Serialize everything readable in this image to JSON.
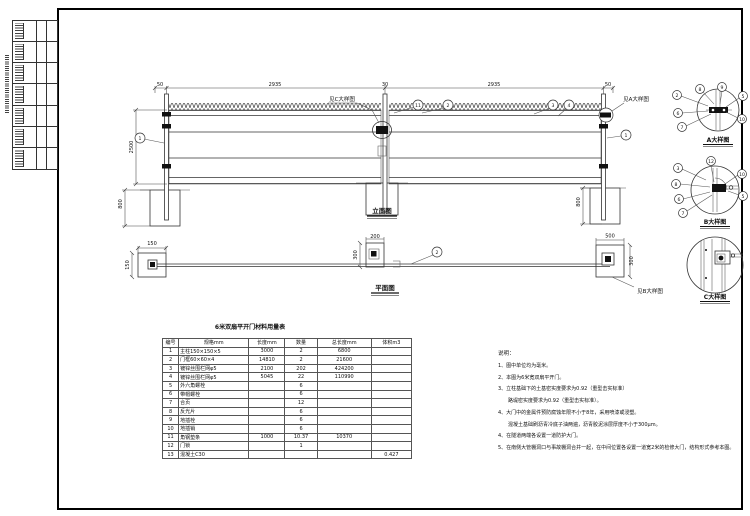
{
  "frame": {
    "margin_text": ""
  },
  "elevation": {
    "label": "立面图",
    "dims": {
      "top_left_offset": "50",
      "leaf1": "2935",
      "center_gap": "30",
      "leaf2": "2935",
      "top_right_offset": "50",
      "gate_height": "2500",
      "footing_left": "800",
      "footing_right": "800"
    },
    "refs": {
      "detail_a": "见A大样图",
      "detail_c": "见C大样图"
    },
    "callouts": {
      "left_post": "1",
      "center_left": "11",
      "center_right": "2",
      "right_a": "3",
      "right_b": "4",
      "right_post": "1"
    }
  },
  "plan": {
    "label": "平面图",
    "dims": {
      "left_block_w": "150",
      "left_block_h": "150",
      "center_block_w": "200",
      "center_block_h": "300",
      "right_block_w": "500",
      "right_block_h": "300"
    },
    "ref_detail_b": "见B大样图",
    "callout_rail": "2"
  },
  "details": {
    "a": {
      "label": "A大样图",
      "callouts": [
        "2",
        "8",
        "9",
        "5",
        "6",
        "7",
        "10"
      ]
    },
    "b": {
      "label": "B大样图",
      "callouts": [
        "3",
        "12",
        "8",
        "6",
        "7",
        "10",
        "5"
      ]
    },
    "c": {
      "label": "C大样图"
    }
  },
  "table": {
    "title": "6米双扇平开门材料用量表",
    "headers": [
      "编号",
      "规格mm",
      "长度mm",
      "数量",
      "总长度mm",
      "体积m3"
    ],
    "rows": [
      [
        "1",
        "主柱150×150×5",
        "3000",
        "2",
        "6800",
        ""
      ],
      [
        "2",
        "门框60×60×4",
        "14810",
        "2",
        "21600",
        ""
      ],
      [
        "3",
        "镀锌丝围栏网φ5",
        "2100",
        "202",
        "424200",
        ""
      ],
      [
        "4",
        "镀锌丝围栏网φ5",
        "5045",
        "22",
        "110990",
        ""
      ],
      [
        "5",
        "外六角螺栓",
        "",
        "6",
        "",
        ""
      ],
      [
        "6",
        "带帽螺栓",
        "",
        "6",
        "",
        ""
      ],
      [
        "7",
        "合页",
        "",
        "12",
        "",
        ""
      ],
      [
        "8",
        "反光片",
        "",
        "6",
        "",
        ""
      ],
      [
        "9",
        "地插栓",
        "",
        "6",
        "",
        ""
      ],
      [
        "10",
        "地插销",
        "",
        "6",
        "",
        ""
      ],
      [
        "11",
        "角钢垫条",
        "1000",
        "10.37",
        "10370",
        ""
      ],
      [
        "12",
        "门锁",
        "",
        "1",
        "",
        ""
      ],
      [
        "13",
        "混凝土C30",
        "",
        "",
        "",
        "0.427"
      ]
    ]
  },
  "notes": {
    "heading": "说明：",
    "items": [
      "1、图中单位均为毫米。",
      "2、本图为6米宽双扇平开门。",
      "3、立柱基础下的土基密实度要求为0.92（重型击实标准）",
      "　　路堤密实度要求为0.92（重型击实标准）。",
      "4、大门中的金属件预防腐蚀年限不小于8年，采用喷漆或浸塑。",
      "　　混凝土基础刷沥青冷底子油两遍，沥青胶泥涂层厚度不小于300μm。",
      "4、在隧道两端各设置一道防护大门。",
      "5、在南侧大管棚洞口与事故棚洞合并一起，在中间位置各设置一道宽2米的检修大门，结构形式参考本图。"
    ]
  }
}
